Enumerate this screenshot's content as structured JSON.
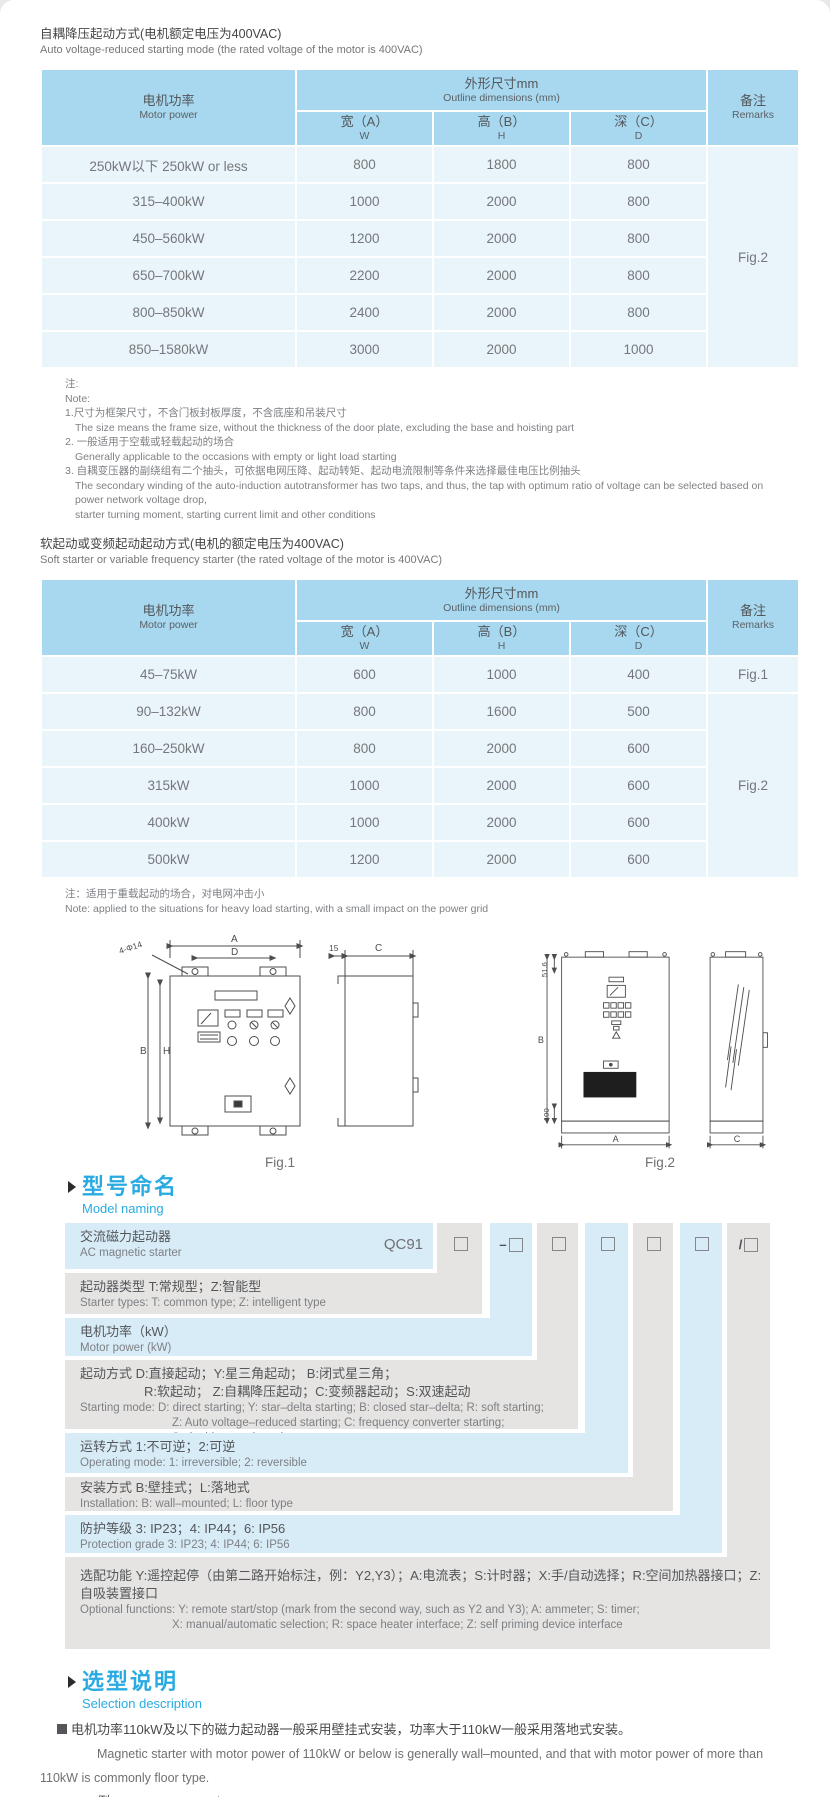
{
  "table1": {
    "title_zh": "自耦降压起动方式(电机额定电压为400VAC)",
    "title_en": "Auto voltage-reduced starting mode (the rated voltage of the motor is 400VAC)",
    "headers": {
      "power_zh": "电机功率",
      "power_en": "Motor power",
      "dims_zh": "外形尺寸mm",
      "dims_en": "Outline dimensions (mm)",
      "w_zh": "宽（A）",
      "w_en": "W",
      "h_zh": "高（B）",
      "h_en": "H",
      "d_zh": "深（C）",
      "d_en": "D",
      "remarks_zh": "备注",
      "remarks_en": "Remarks"
    },
    "rows": [
      {
        "power": "250kW以下 250kW or less",
        "w": "800",
        "h": "1800",
        "d": "800"
      },
      {
        "power": "315–400kW",
        "w": "1000",
        "h": "2000",
        "d": "800"
      },
      {
        "power": "450–560kW",
        "w": "1200",
        "h": "2000",
        "d": "800"
      },
      {
        "power": "650–700kW",
        "w": "2200",
        "h": "2000",
        "d": "800"
      },
      {
        "power": "800–850kW",
        "w": "2400",
        "h": "2000",
        "d": "800"
      },
      {
        "power": "850–1580kW",
        "w": "3000",
        "h": "2000",
        "d": "1000"
      }
    ],
    "remark": "Fig.2"
  },
  "notes1": {
    "lines": [
      {
        "text": "注:"
      },
      {
        "text": "Note:"
      },
      {
        "text": "1.尺寸为框架尺寸，不含门板封板厚度，不含底座和吊装尺寸"
      },
      {
        "text": "The size means the frame size, without the thickness of the door plate, excluding the base and hoisting part"
      },
      {
        "text": "2. 一般适用于空载或轻载起动的场合"
      },
      {
        "text": "Generally applicable to the occasions with empty or light load starting"
      },
      {
        "text": "3. 自耦变压器的副绕组有二个抽头，可依据电网压降、起动转矩、起动电流限制等条件来选择最佳电压比例抽头"
      },
      {
        "text": "The secondary winding of the auto-induction autotransformer has two taps, and thus, the tap with optimum ratio of voltage can be selected based on power network voltage drop,"
      },
      {
        "text": "starter turning moment, starting current limit and other conditions"
      }
    ]
  },
  "table2": {
    "title_zh": "软起动或变频起动起动方式(电机的额定电压为400VAC)",
    "title_en": "Soft starter or variable frequency starter (the rated voltage of the motor is 400VAC)",
    "headers": {
      "power_zh": "电机功率",
      "power_en": "Motor power",
      "dims_zh": "外形尺寸mm",
      "dims_en": "Outline dimensions (mm)",
      "w_zh": "宽（A）",
      "w_en": "W",
      "h_zh": "高（B）",
      "h_en": "H",
      "d_zh": "深（C）",
      "d_en": "D",
      "remarks_zh": "备注",
      "remarks_en": "Remarks"
    },
    "rows": [
      {
        "power": "45–75kW",
        "w": "600",
        "h": "1000",
        "d": "400"
      },
      {
        "power": "90–132kW",
        "w": "800",
        "h": "1600",
        "d": "500"
      },
      {
        "power": "160–250kW",
        "w": "800",
        "h": "2000",
        "d": "600"
      },
      {
        "power": "315kW",
        "w": "1000",
        "h": "2000",
        "d": "600"
      },
      {
        "power": "400kW",
        "w": "1000",
        "h": "2000",
        "d": "600"
      },
      {
        "power": "500kW",
        "w": "1200",
        "h": "2000",
        "d": "600"
      }
    ],
    "remark_row1": "Fig.1",
    "remark_rest": "Fig.2"
  },
  "note2": {
    "zh": "注：适用于重载起动的场合，对电网冲击小",
    "en": "Note: applied to the situations for heavy load starting, with a small impact on the power grid"
  },
  "figures": {
    "fig1": {
      "caption": "Fig.1",
      "dim_a": "A",
      "dim_d": "D",
      "dim_holes": "4-Φ14",
      "dim_b": "B",
      "dim_h": "H",
      "dim_15": "15",
      "dim_c": "C"
    },
    "fig2": {
      "caption": "Fig.2",
      "dim_516": "51.6",
      "dim_b": "B",
      "dim_100": "100",
      "dim_a": "A",
      "dim_c": "C"
    }
  },
  "naming": {
    "heading_zh": "型号命名",
    "heading_en": "Model naming",
    "code": "QC91",
    "box_prefixes": [
      "",
      "–",
      "",
      "",
      "",
      "",
      "/"
    ],
    "rows": [
      {
        "zh": "交流磁力起动器",
        "en": "AC magnetic starter"
      },
      {
        "zh": "起动器类型 T:常规型；Z:智能型",
        "en": "Starter types: T: common type; Z: intelligent type"
      },
      {
        "zh": "电机功率（kW）",
        "en": "Motor power (kW)"
      },
      {
        "zh1": "起动方式 D:直接起动；Y:星三角起动；  B:闭式星三角；",
        "zh2": "R:软起动；  Z:自耦降压起动；C:变频器起动；S:双速起动",
        "en1": "Starting mode: D: direct starting; Y: star–delta starting; B: closed star–delta; R: soft starting;",
        "en2": "Z: Auto voltage–reduced starting; C: frequency converter starting;",
        "en3": "S: double speed starting"
      },
      {
        "zh": "运转方式 1:不可逆；2:可逆",
        "en": "Operating mode: 1: irreversible; 2: reversible"
      },
      {
        "zh": "安装方式 B:壁挂式；L:落地式",
        "en": "Installation: B: wall–mounted;  L: floor type"
      },
      {
        "zh": "防护等级  3: IP23；4: IP44；6: IP56",
        "en": "Protection grade  3: IP23;  4: IP44;  6: IP56"
      },
      {
        "zh": "选配功能  Y:遥控起停（由第二路开始标注，例：Y2,Y3）；A:电流表；S:计时器；X:手/自动选择；R:空间加热器接口；Z:自吸装置接口",
        "en1": "Optional functions: Y: remote start/stop (mark from the second way, such as Y2 and Y3); A: ammeter; S: timer;",
        "en2": "X: manual/automatic selection; R: space heater interface; Z: self priming device interface"
      }
    ]
  },
  "selection": {
    "heading_zh": "选型说明",
    "heading_en": "Selection description",
    "para_zh": "电机功率110kW及以下的磁力起动器一般采用壁挂式安装，功率大于110kW一般采用落地式安装。",
    "para_en": "Magnetic starter with motor power of 110kW or below is generally wall–mounted, and that with motor power of more than 110kW is commonly floor type.",
    "example": "例：QC91T-30D1B4/AS",
    "explain_zh": "表示常规的交流起动器，功率为30kW,直接起动，不可逆，IP44，配置电流表和计时器",
    "explain_en": "It means: AC magnetic starter, power is 30kW, DOL starting mode, irreversible, IP44, with ammeter and timer."
  }
}
